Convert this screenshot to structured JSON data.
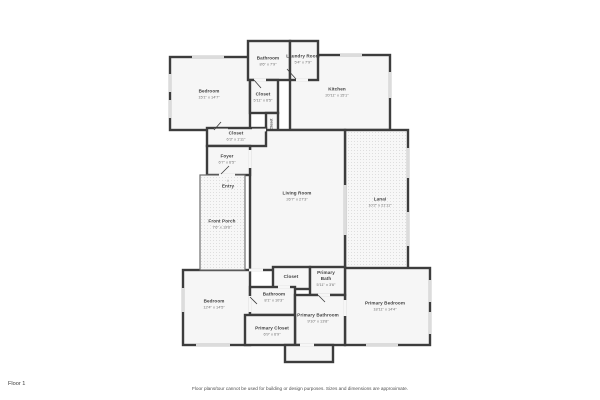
{
  "floor": {
    "label": "Floor 1"
  },
  "footer": {
    "disclaimer": "Floor plans/tour cannot be used for building or design purposes. Sizes and dimensions are approximate."
  },
  "icons": {
    "entry_marker": "▲"
  },
  "colors": {
    "wall": "#3d3d3d",
    "floor_fill": "#f6f6f6",
    "window": "#dcdcdc",
    "porch_dot": "#dedede"
  },
  "rooms": {
    "bedroom_top": {
      "name": "Bedroom",
      "dims": "15'1\" x 14'7\""
    },
    "bathroom_top": {
      "name": "Bathroom",
      "dims": "8'6\" x 7'9\""
    },
    "laundry_room": {
      "name": "Laundry Room",
      "dims": "5'4\" x 7'9\""
    },
    "kitchen": {
      "name": "Kitchen",
      "dims": "20'11\" x 15'1\""
    },
    "closet_top": {
      "name": "Closet",
      "dims": "5'11\" x 6'5\""
    },
    "closet_small": {
      "name": "Closet",
      "dims": ""
    },
    "closet_hall": {
      "name": "Closet",
      "dims": "6'3\" x 1'11\""
    },
    "foyer": {
      "name": "Foyer",
      "dims": "6'7\" x 6'5\""
    },
    "entry": {
      "name": "Entry",
      "dims": ""
    },
    "front_porch": {
      "name": "Front Porch",
      "dims": "7'6\" x 19'6\""
    },
    "living_room": {
      "name": "Living Room",
      "dims": "26'7\" x 27'3\""
    },
    "lanai": {
      "name": "Lanai",
      "dims": "10'2\" x 21'11\""
    },
    "bedroom_bottom": {
      "name": "Bedroom",
      "dims": "12'4\" x 14'5\""
    },
    "bathroom_bottom": {
      "name": "Bathroom",
      "dims": "8'1\" x 10'3\""
    },
    "closet_bottom": {
      "name": "Closet",
      "dims": ""
    },
    "primary_bath": {
      "name": "Primary Bath",
      "dims": "5'11\" x 3'6\""
    },
    "primary_bathroom": {
      "name": "Primary Bathroom",
      "dims": "9'10\" x 13'8\""
    },
    "primary_closet": {
      "name": "Primary Closet",
      "dims": "6'9\" x 6'9\""
    },
    "primary_bedroom": {
      "name": "Primary Bedroom",
      "dims": "18'11\" x 14'4\""
    }
  }
}
